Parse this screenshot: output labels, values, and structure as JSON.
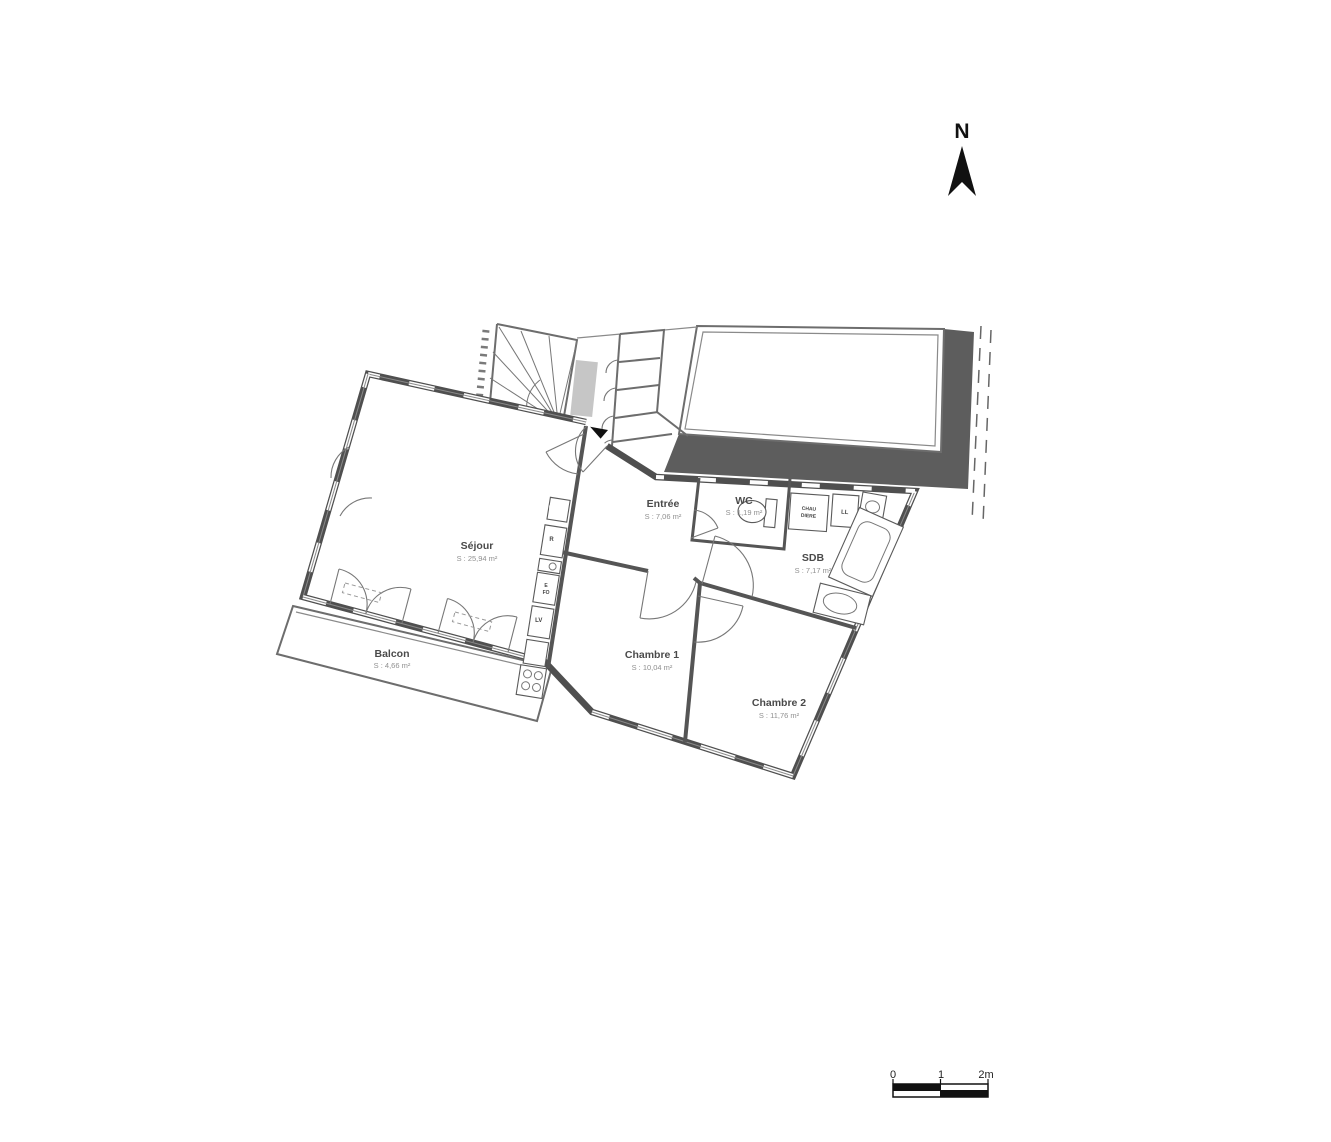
{
  "north_arrow": {
    "label": "N"
  },
  "rooms": {
    "sejour": {
      "name": "Séjour",
      "area": "S : 25,94 m²"
    },
    "balcon": {
      "name": "Balcon",
      "area": "S : 4,66 m²"
    },
    "entree": {
      "name": "Entrée",
      "area": "S : 7,06 m²"
    },
    "wc": {
      "name": "WC",
      "area": "S : 1,19 m²"
    },
    "sdb": {
      "name": "SDB",
      "area": "S : 7,17 m²"
    },
    "chambre1": {
      "name": "Chambre 1",
      "area": "S : 10,04 m²"
    },
    "chambre2": {
      "name": "Chambre 2",
      "area": "S : 11,76 m²"
    }
  },
  "kitchen": {
    "panel": "ELEC",
    "fridge": "R",
    "oven_line1": "E",
    "oven_line2": "FO",
    "dishwasher": "LV"
  },
  "utility": {
    "boiler_line1": "CHAU",
    "boiler_line2": "DIERE",
    "washing_machine": "LL"
  },
  "scale_bar": {
    "tick0": "0",
    "tick1": "1",
    "tick2": "2m"
  },
  "colors": {
    "wall": "#4f4f4f",
    "terrace_band": "#5d5d5d",
    "duct_fill": "#c6c6c6",
    "north_fill": "#111111",
    "scale_black": "#111111"
  }
}
